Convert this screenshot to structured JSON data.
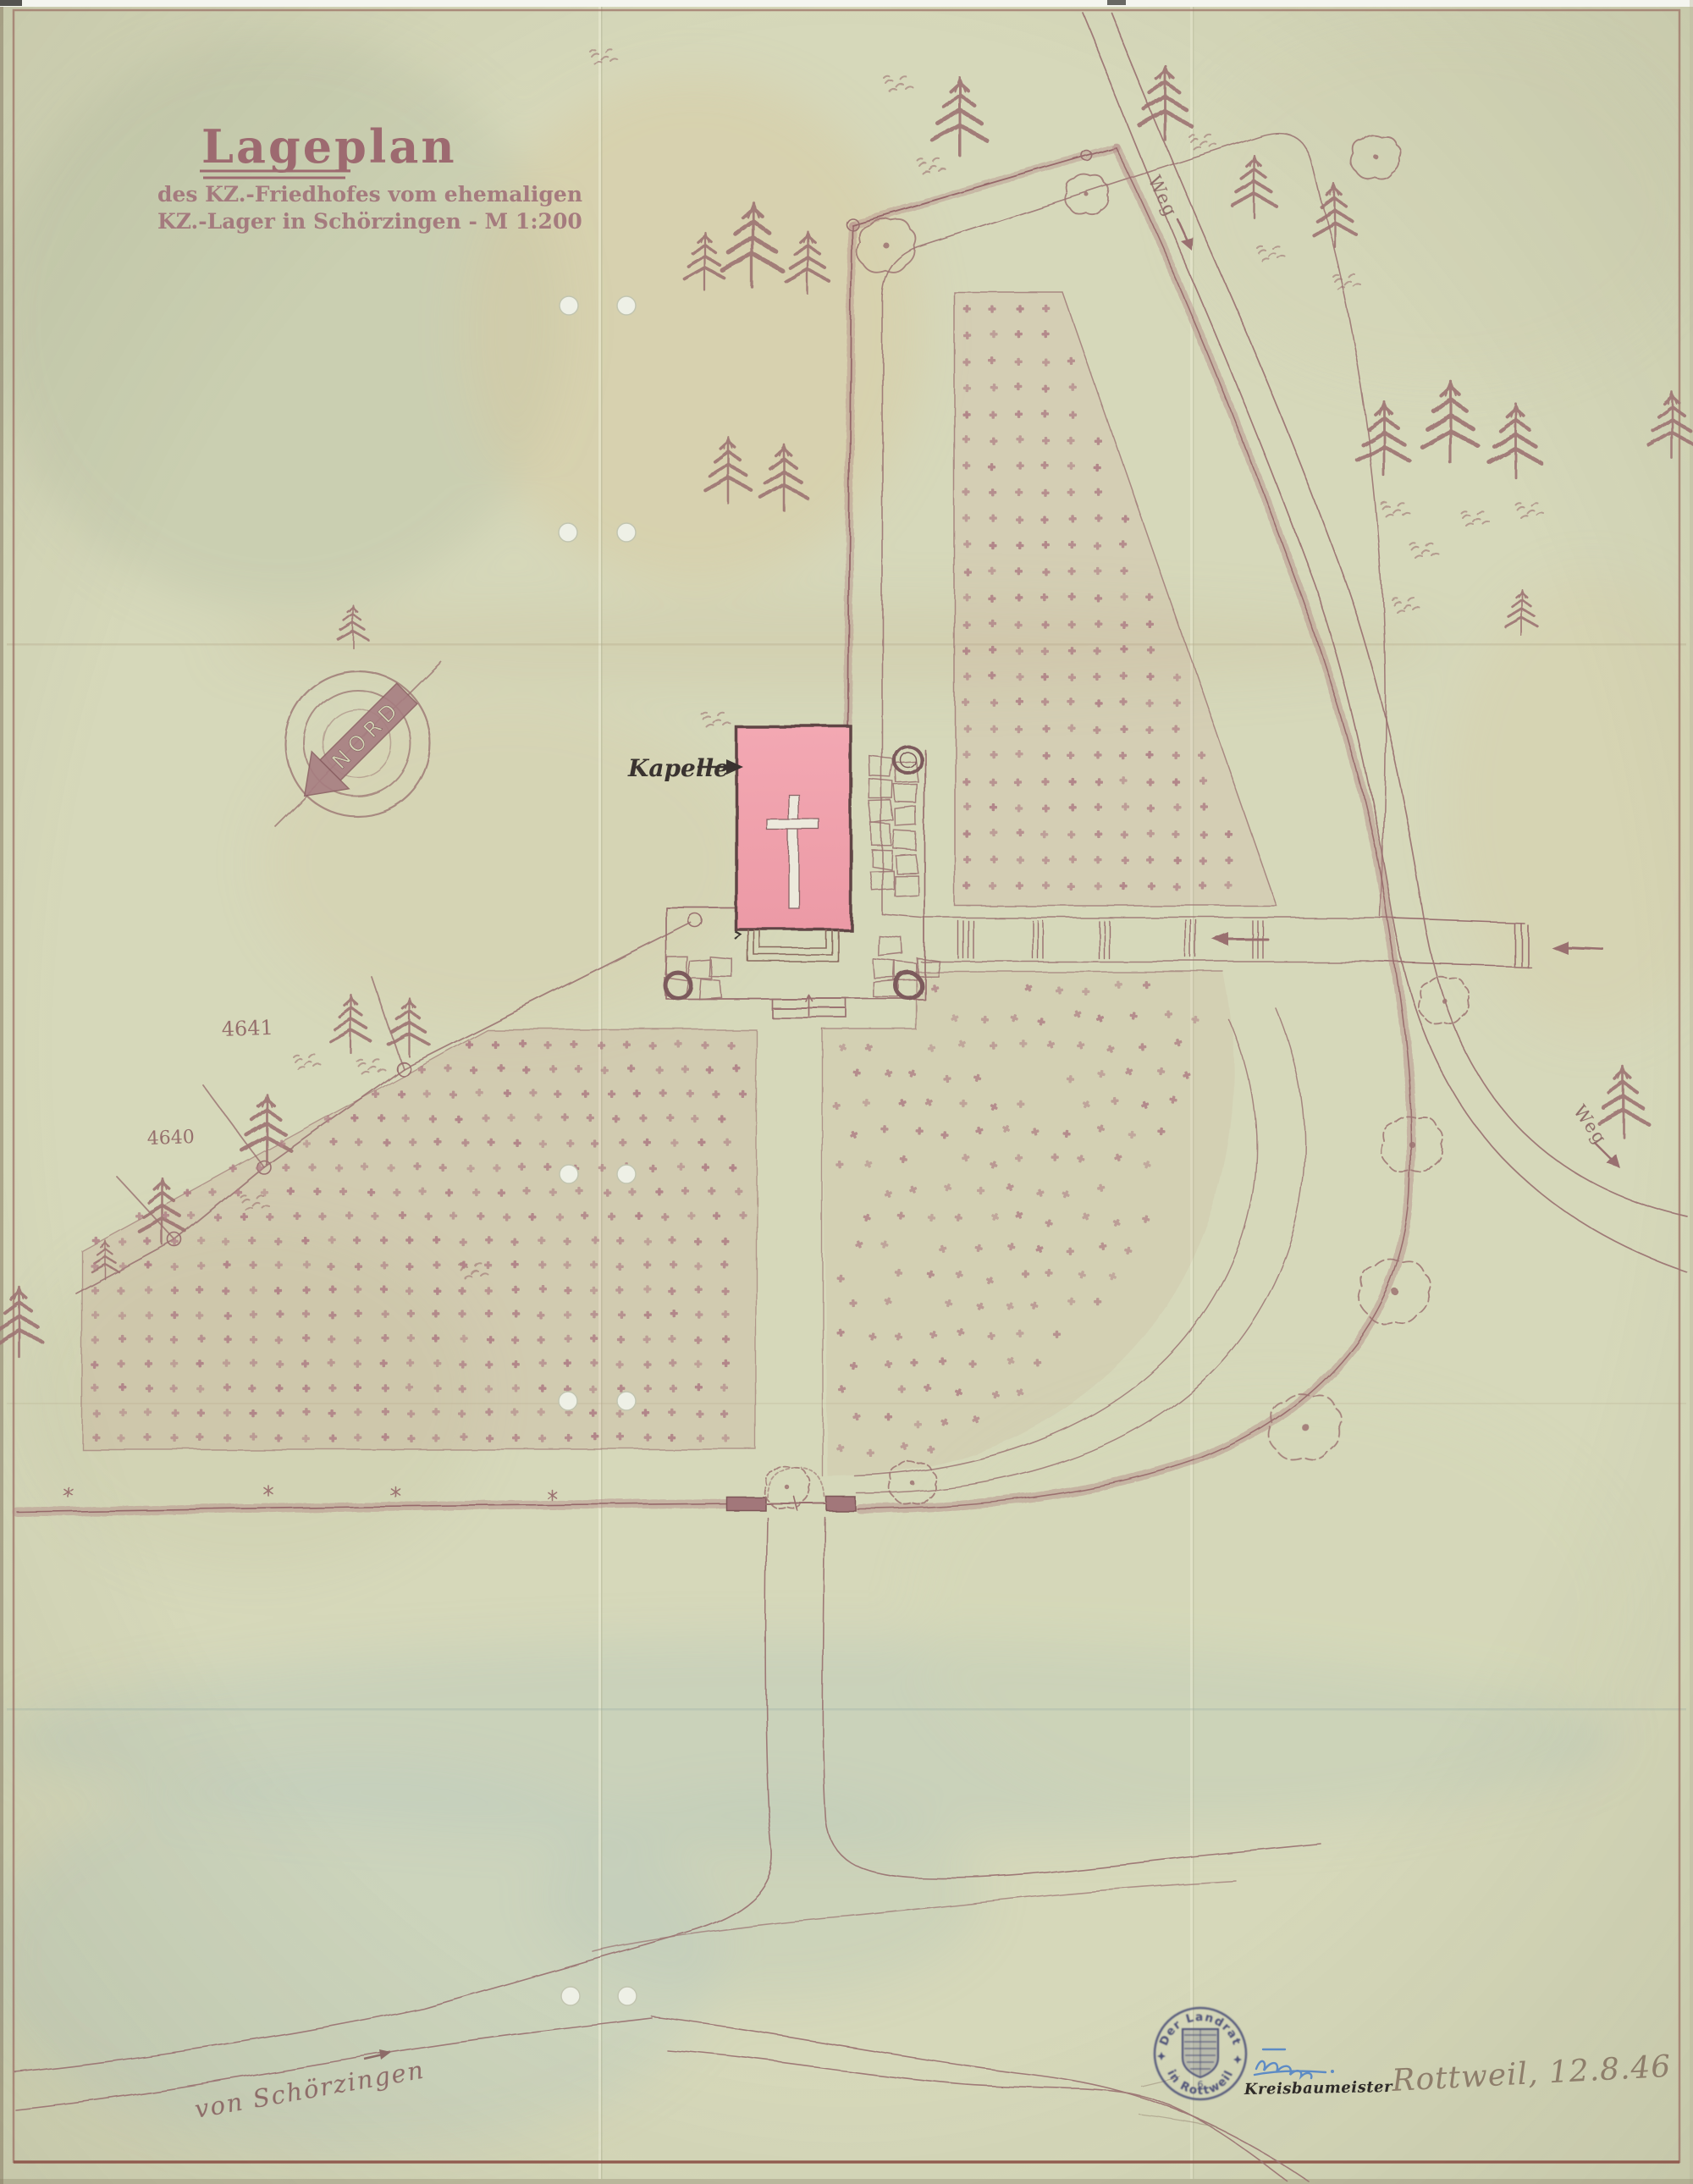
{
  "document": {
    "title": "Lageplan",
    "subtitle_line1": "des KZ.-Friedhofes vom ehemaligen",
    "subtitle_line2": "KZ.-Lager in Schörzingen - M 1:200"
  },
  "labels": {
    "chapel": "Kapelle",
    "parcel_upper": "4641",
    "parcel_lower": "4640",
    "weg_upper": "Weg",
    "weg_lower": "Weg",
    "north": "NORD",
    "road_bottom": "von Schörzingen"
  },
  "stamp": {
    "arc_top": "Der Landrat",
    "arc_bottom": "in Rottweil",
    "small_digit": "6",
    "office": "Kreisbaumeister",
    "handwritten_place_date": "Rottweil, 12.8.46"
  },
  "colors": {
    "paper": "#d6d8ba",
    "ink": "#997070",
    "hedge": "#ab7e7e",
    "grave_cross": "#b08287",
    "chapel_fill": "#f0a2ad",
    "chapel_edge": "#5f4444",
    "title_ink": "#9d6a70",
    "stamp_ink": "#4e5178",
    "signature_blue": "#5d8bc5",
    "pencil": "#8e7e6b",
    "label_black": "#3a3330"
  }
}
